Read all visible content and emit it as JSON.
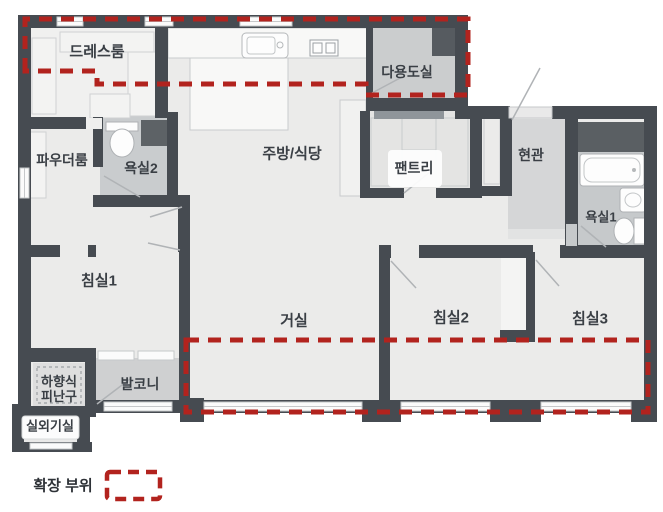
{
  "plan": {
    "rooms": [
      {
        "id": "dressroom",
        "label": "드레스룸"
      },
      {
        "id": "powder_room",
        "label": "파우더룸"
      },
      {
        "id": "bathroom2",
        "label": "욕실2"
      },
      {
        "id": "kitchen_dining",
        "label": "주방/식당"
      },
      {
        "id": "utility_room",
        "label": "다용도실"
      },
      {
        "id": "pantry",
        "label": "팬트리"
      },
      {
        "id": "entrance",
        "label": "현관"
      },
      {
        "id": "bathroom1",
        "label": "욕실1"
      },
      {
        "id": "bedroom1",
        "label": "침실1"
      },
      {
        "id": "living_room",
        "label": "거실"
      },
      {
        "id": "bedroom2",
        "label": "침실2"
      },
      {
        "id": "bedroom3",
        "label": "침실3"
      },
      {
        "id": "balcony",
        "label": "발코니"
      },
      {
        "id": "escape_hatch",
        "label": "하향식 피난구",
        "line1": "하향식",
        "line2": "피난구"
      },
      {
        "id": "outdoor_unit_room",
        "label": "실외기실"
      }
    ],
    "legend": {
      "label": "확장 부위"
    },
    "colors": {
      "wall": "#464b51",
      "accent_red": "#b2231e",
      "floor": "#ebebea",
      "floor_gray": "#cdced0",
      "bath_floor": "#c6c9cb",
      "text": "#3a3f45"
    }
  }
}
